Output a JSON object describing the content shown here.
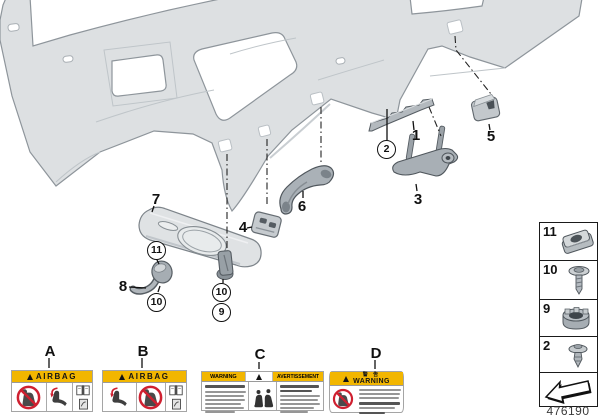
{
  "doc_number": "476190",
  "callouts": {
    "1": "1",
    "2": "2",
    "3": "3",
    "4": "4",
    "5": "5",
    "6": "6",
    "7": "7",
    "8": "8",
    "9": "9",
    "10": "10",
    "11": "11"
  },
  "section_labels": {
    "a": "A",
    "b": "B",
    "c": "C",
    "d": "D"
  },
  "sidebar": {
    "rows": [
      {
        "label": "11",
        "icon": "clip-nut-icon"
      },
      {
        "label": "10",
        "icon": "screw-icon"
      },
      {
        "label": "9",
        "icon": "grommet-icon"
      },
      {
        "label": "2",
        "icon": "expansion-rivet-icon"
      }
    ],
    "arrow_icon": "direction-arrow-icon"
  },
  "warning_labels": {
    "airbag_text": "AIRBAG",
    "warning_en": "WARNING",
    "warning_fr": "AVERTISSEMENT",
    "warning_cn": "警 告",
    "warning_d_en": "WARNING"
  },
  "colors": {
    "label_yellow": "#f2b600",
    "prohibition_red": "#cf2030",
    "panel_gray": "#dde0e2",
    "part_gray": "#aab1b7"
  }
}
